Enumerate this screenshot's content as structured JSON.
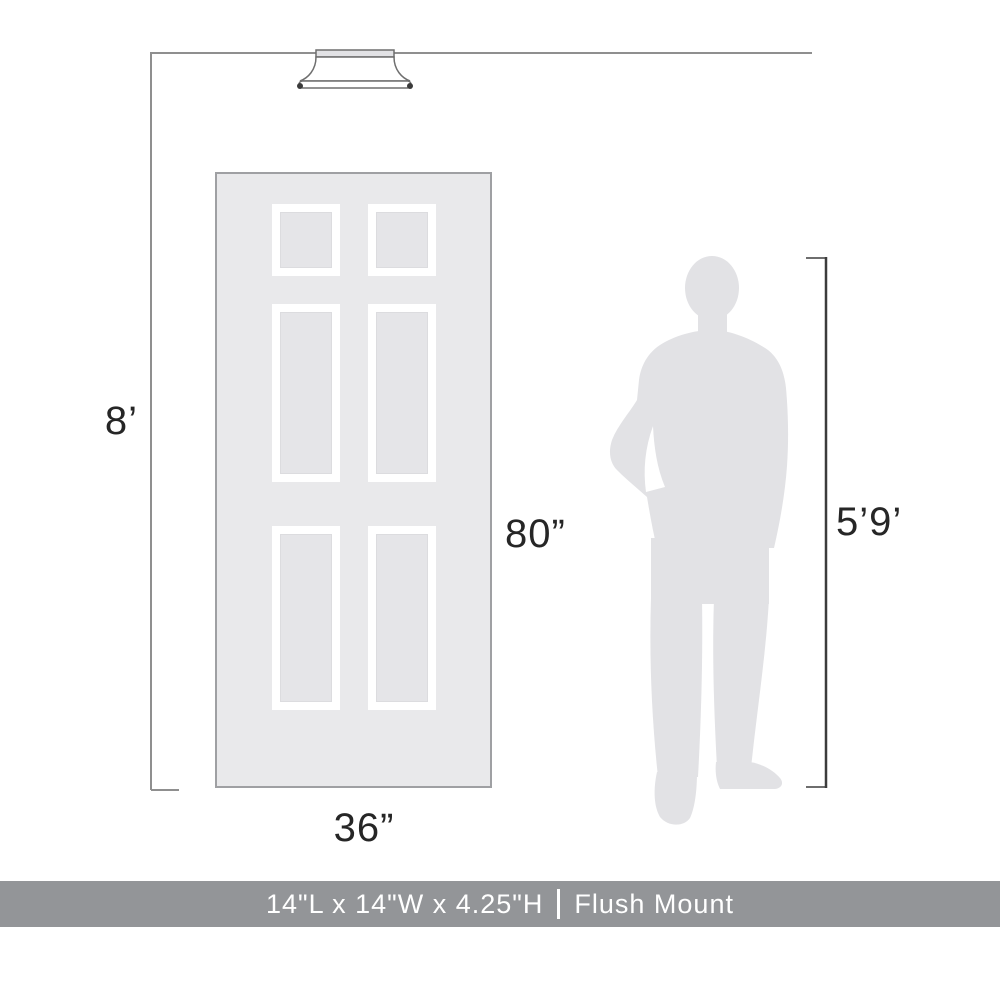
{
  "diagram": {
    "ceiling_height_label": "8’",
    "door_height_label": "80”",
    "door_width_label": "36”",
    "person_height_label": "5’9’",
    "scale_note": "ceiling 8 ft, door 36 in x 80 in, person 5 ft 9 in"
  },
  "footer": {
    "dimensions_label": "14\"L x 14\"W x 4.25\"H",
    "separator": "|",
    "mount_type_label": "Flush Mount"
  },
  "colors": {
    "background": "#ffffff",
    "door_fill": "#e9e9eb",
    "door_border": "#9fa0a3",
    "panel_frame": "#ffffff",
    "panel_inner_fill": "#e5e5e8",
    "silhouette_fill": "#e2e2e5",
    "room_dimension_line": "#8f8f8f",
    "person_dimension_line": "#3c3c3c",
    "fixture_outline": "#6f6f6f",
    "label_text": "#262626",
    "footer_background": "#939598",
    "footer_text": "#ffffff"
  }
}
